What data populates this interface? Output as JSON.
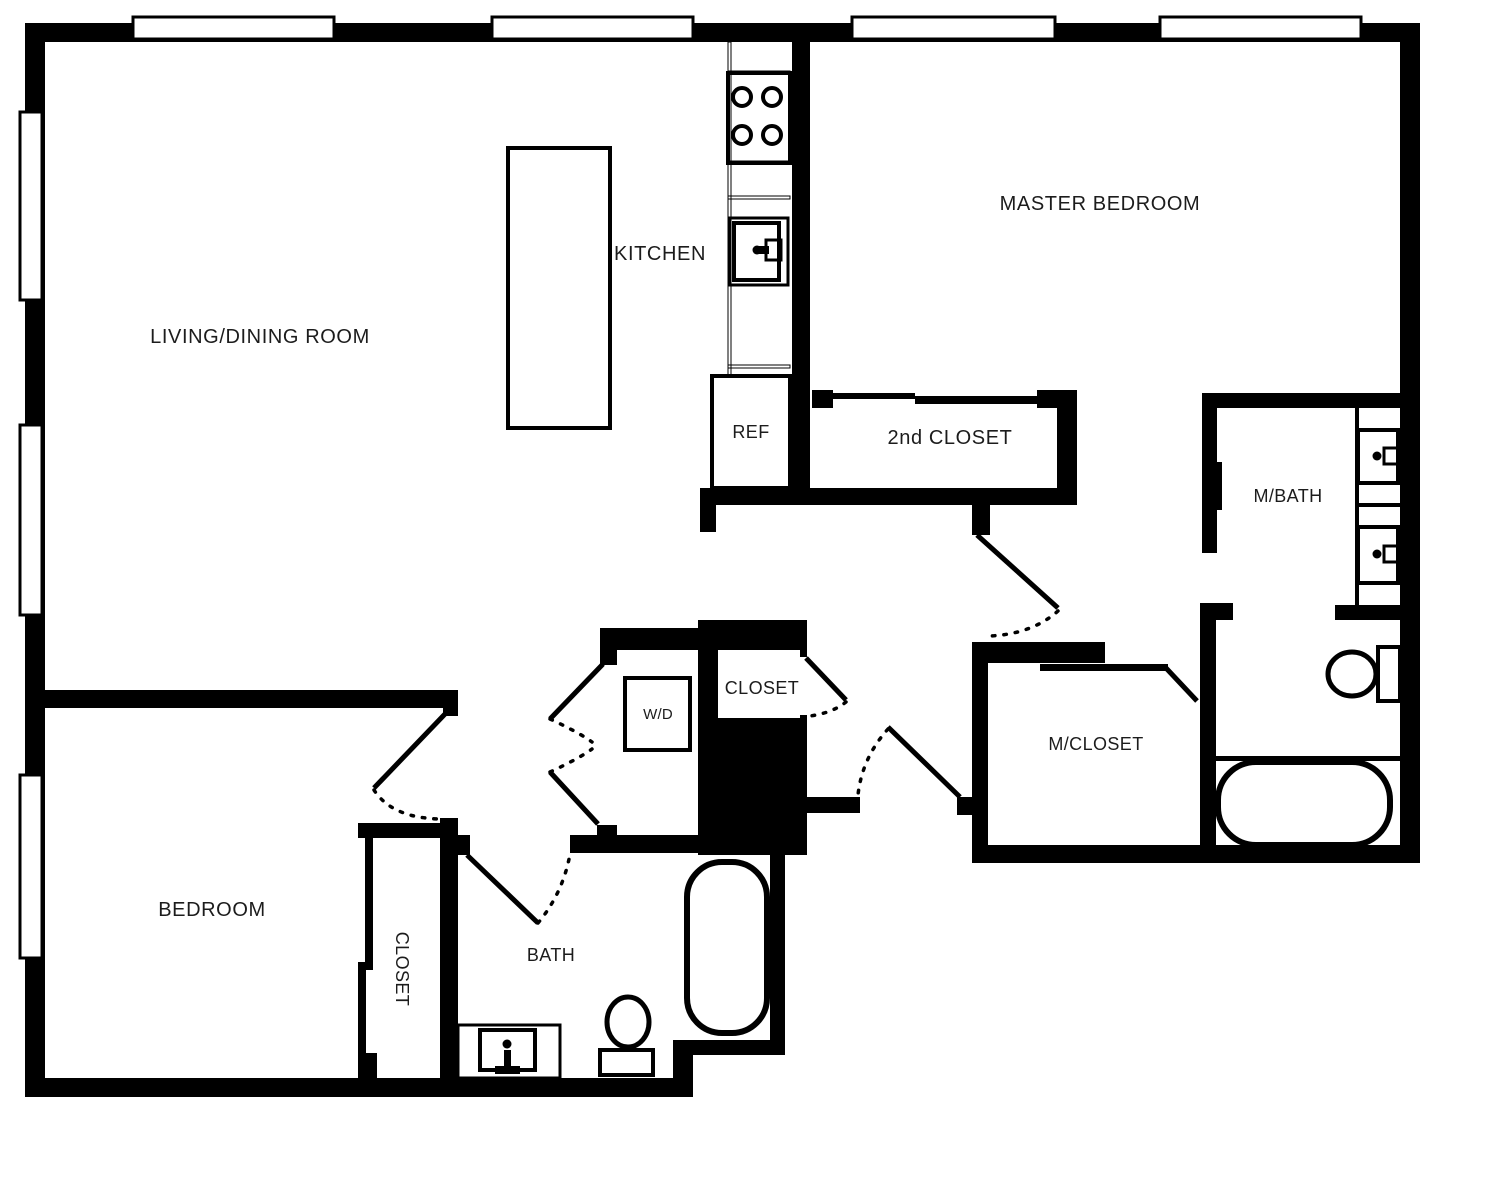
{
  "plan": {
    "rooms": {
      "living_dining": "LIVING/DINING ROOM",
      "kitchen": "KITCHEN",
      "master_bedroom": "MASTER BEDROOM",
      "bedroom": "BEDROOM",
      "bath": "BATH",
      "master_bath": "M/BATH",
      "master_closet": "M/CLOSET",
      "second_closet": "2nd CLOSET",
      "hall_closet": "CLOSET",
      "bedroom_closet": "CLOSET",
      "washer_dryer": "W/D",
      "refrigerator": "REF"
    },
    "colors": {
      "wall": "#000000",
      "floor": "#ffffff",
      "text": "#1c1c1c"
    }
  }
}
